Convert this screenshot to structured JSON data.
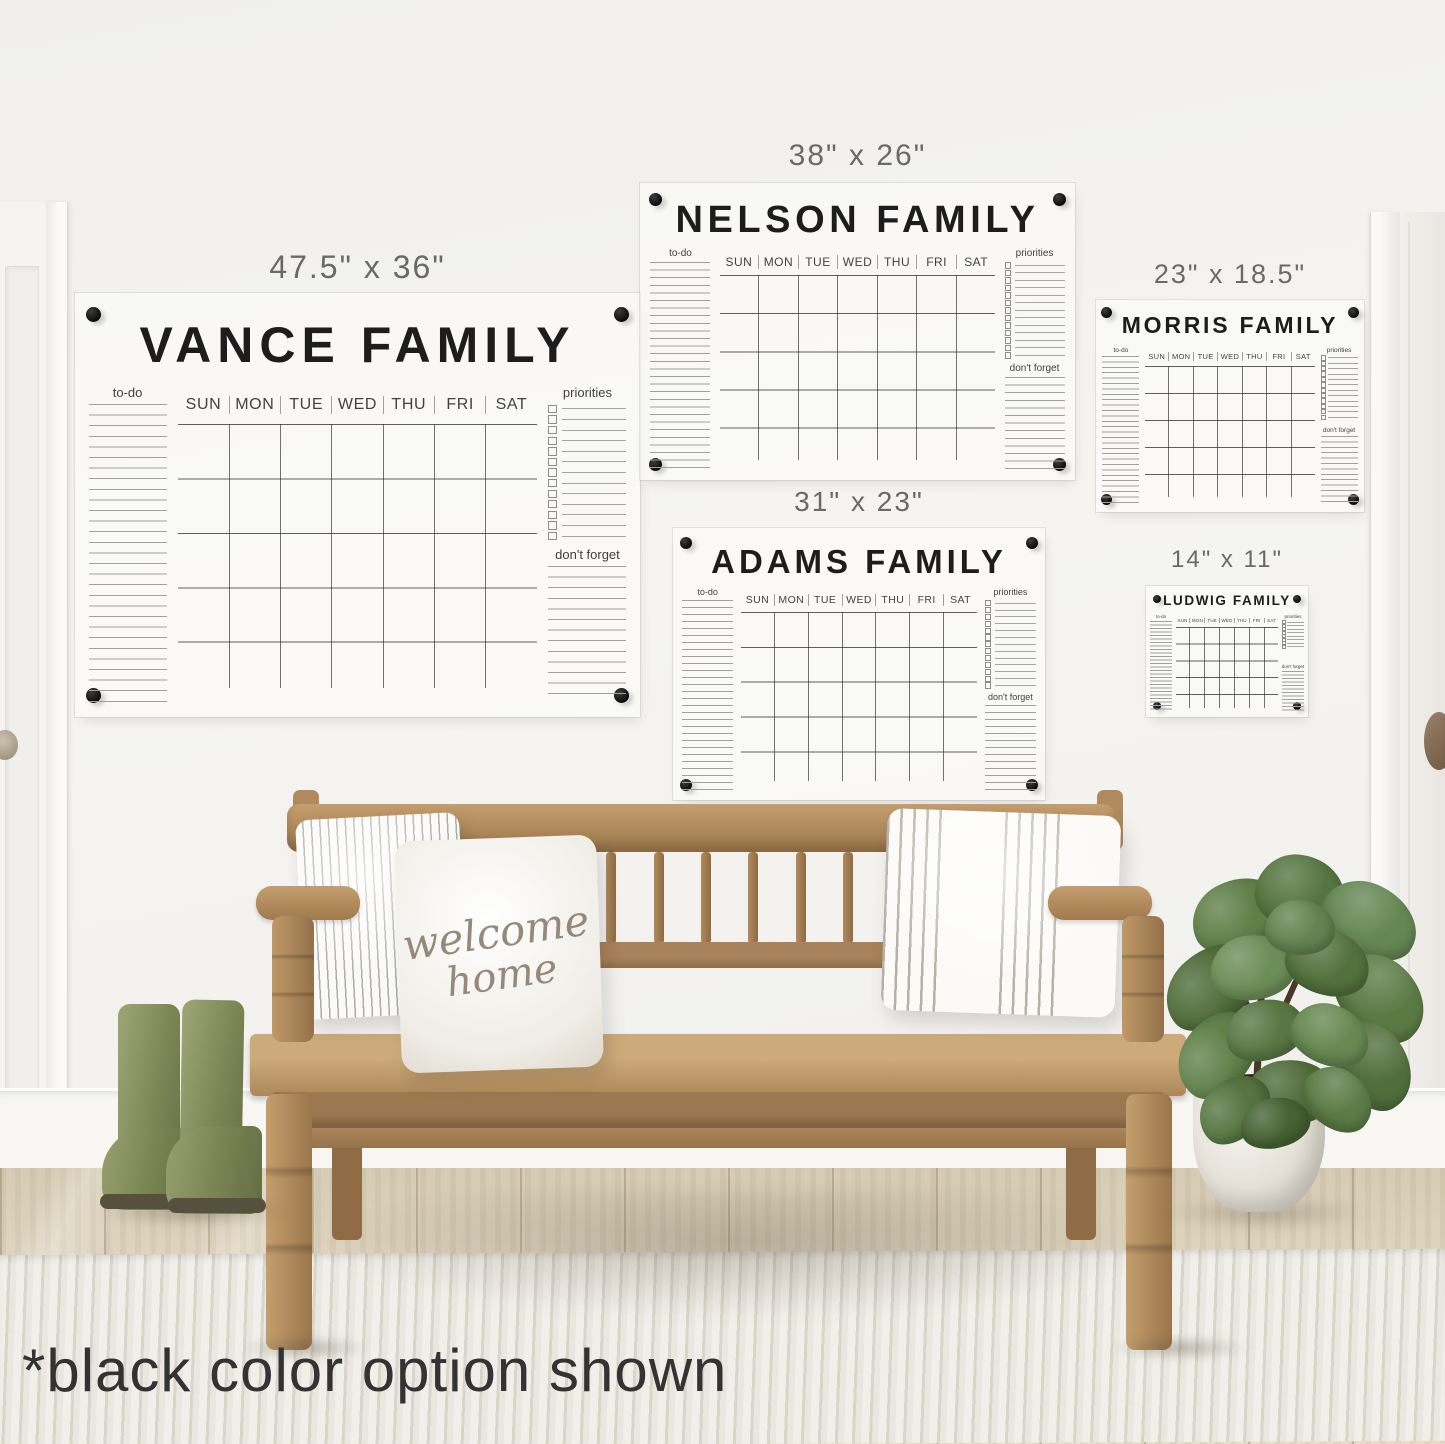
{
  "caption": "*black color option shown",
  "calendar_common": {
    "todo_label": "to-do",
    "priorities_label": "priorities",
    "dont_forget_label": "don't forget",
    "days": [
      "SUN",
      "MON",
      "TUE",
      "WED",
      "THU",
      "FRI",
      "SAT"
    ]
  },
  "calendars": [
    {
      "id": "vance",
      "title": "VANCE FAMILY",
      "size_label": "47.5\" x 36\""
    },
    {
      "id": "nelson",
      "title": "NELSON FAMILY",
      "size_label": "38\" x 26\""
    },
    {
      "id": "morris",
      "title": "MORRIS FAMILY",
      "size_label": "23\" x 18.5\""
    },
    {
      "id": "adams",
      "title": "ADAMS FAMILY",
      "size_label": "31\" x 23\""
    },
    {
      "id": "ludwig",
      "title": "LUDWIG FAMILY",
      "size_label": "14\" x 11\""
    }
  ],
  "pillow_text": {
    "line1": "welcome",
    "line2": "home"
  },
  "palette": {
    "calendar_ink": "#2a2a2a",
    "mount_dot": "#111111",
    "size_label_gray": "#6a6a6a",
    "wood": "#b59065",
    "boots_green": "#87915f",
    "leaf_green": "#587743",
    "wall": "#f3f2ef"
  }
}
